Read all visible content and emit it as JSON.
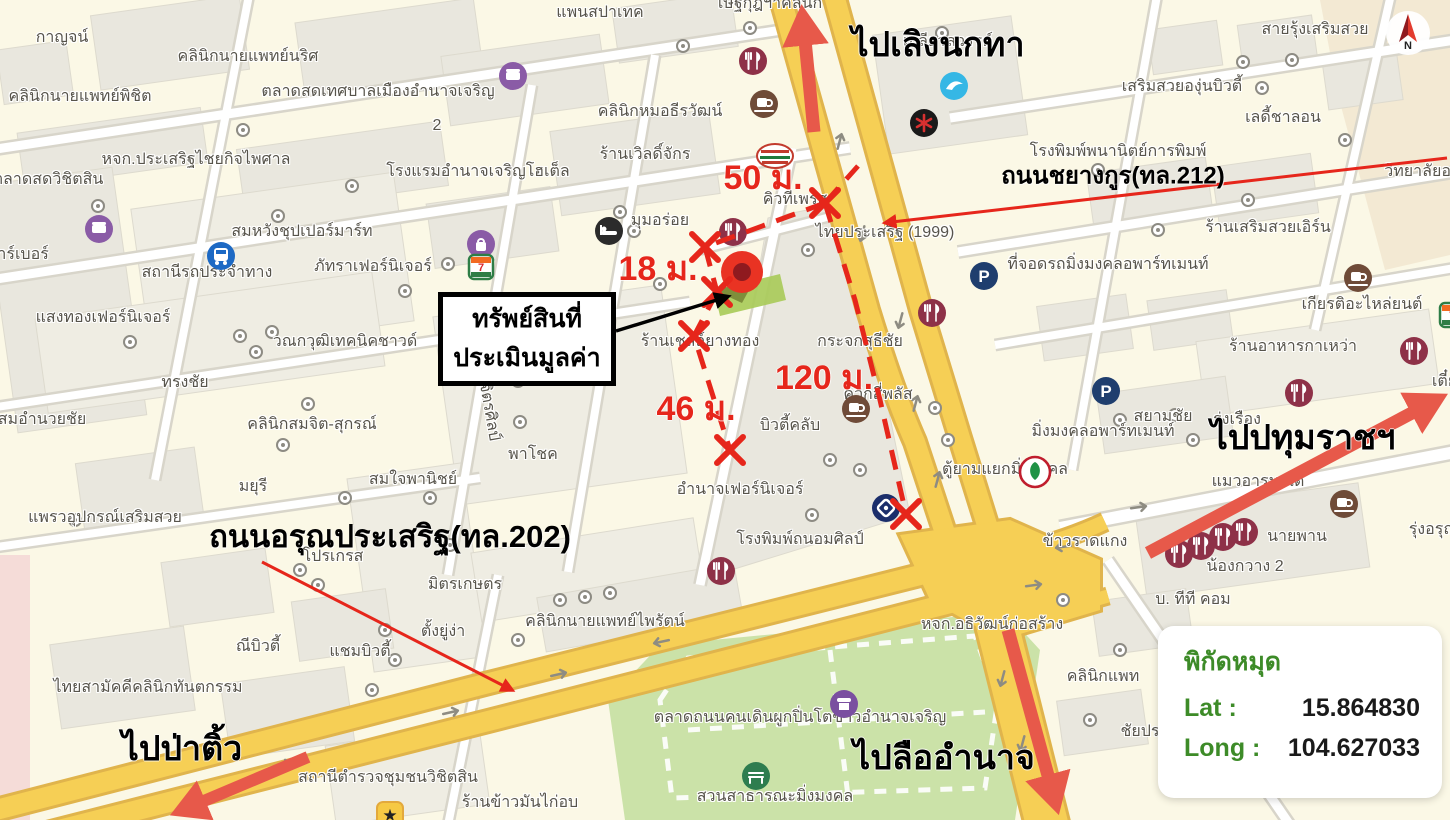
{
  "colors": {
    "land": "#FBF8E6",
    "block": "#E9E7DE",
    "block_light": "#EFEDE3",
    "beige": "#F3E9D3",
    "pink": "#F5DCD8",
    "road_casing": "#D8D5CA",
    "road_fill": "#FFFFFF",
    "yellow": "#F6CF55",
    "yellow_casing": "#E0B44C",
    "park": "#CBE2A8",
    "overlay_red": "#E6261B",
    "arrow_salmon": "#E7594A",
    "marker_red": "#E93323",
    "marker_core": "#8F1A1F",
    "parcel_green": "#A9CB5A",
    "label_gray": "#57544B",
    "panel_green": "#3D8B28"
  },
  "overlay": {
    "property_label": [
      "ทรัพย์สินที่",
      "ประเมินมูลค่า"
    ],
    "distance_labels": [
      {
        "text": "50 ม.",
        "x": 763,
        "y": 177
      },
      {
        "text": "18 ม.",
        "x": 658,
        "y": 268
      },
      {
        "text": "46 ม.",
        "x": 696,
        "y": 408
      },
      {
        "text": "120 ม.",
        "x": 824,
        "y": 377
      }
    ],
    "direction_labels": [
      {
        "text": "ไปเลิงนกทา",
        "x": 938,
        "y": 44
      },
      {
        "text": "ไปปทุมราชฯ",
        "x": 1303,
        "y": 437
      },
      {
        "text": "ไปป่าติ้ว",
        "x": 182,
        "y": 748
      },
      {
        "text": "ไปลืออำนาจ",
        "x": 944,
        "y": 757
      }
    ],
    "road_labels": [
      {
        "text": "ถนนชยางกูร(ทล.212)",
        "x": 1113,
        "y": 175,
        "size": 24
      },
      {
        "text": "ถนนอรุณประเสริฐ(ทล.202)",
        "x": 390,
        "y": 536,
        "size": 31
      }
    ]
  },
  "coordinates_panel": {
    "title": "พิกัดหมุด",
    "lat_label": "Lat :",
    "lat_value": "15.864830",
    "long_label": "Long :",
    "long_value": "104.627033"
  },
  "compass": {
    "letter": "N"
  },
  "map_labels": [
    {
      "t": "กาญจน์",
      "x": 62,
      "y": 38
    },
    {
      "t": "คลินิกนายแพทย์นริศ",
      "x": 248,
      "y": 57
    },
    {
      "t": "คลินิกนายแพทย์พิชิต",
      "x": 80,
      "y": 97
    },
    {
      "t": "ตลาดสดเทศบาลเมืองอำนาจเจริญ",
      "x": 378,
      "y": 92
    },
    {
      "t": "2",
      "x": 437,
      "y": 126
    },
    {
      "t": "แพนสปาเทค",
      "x": 600,
      "y": 13
    },
    {
      "t": "เษฐ์กุฎฯาคลินิก",
      "x": 770,
      "y": 4
    },
    {
      "t": "เกลียวสวรรค์",
      "x": 948,
      "y": 42
    },
    {
      "t": "สายรุ้งเสริมสวย",
      "x": 1315,
      "y": 30
    },
    {
      "t": "เสริมสวยองุ่นบิวตี้",
      "x": 1182,
      "y": 87
    },
    {
      "t": "เลดี้ชาลอน",
      "x": 1283,
      "y": 118
    },
    {
      "t": "หจก.ประเสริฐไชยกิจไพศาล",
      "x": 196,
      "y": 160
    },
    {
      "t": "ตลาดสดวิชิตสิน",
      "x": 48,
      "y": 180
    },
    {
      "t": "คลินิกหมอธีรวัฒน์",
      "x": 660,
      "y": 112
    },
    {
      "t": "โรงแรมอำนาจเจริญโฮเต็ล",
      "x": 478,
      "y": 172
    },
    {
      "t": "ร้านเวิลดิ์จักร",
      "x": 645,
      "y": 155
    },
    {
      "t": "โรงพิมพ์พนานิตย์การพิมพ์",
      "x": 1118,
      "y": 152
    },
    {
      "t": "วิทยาลัยอาชีว",
      "x": 1432,
      "y": 172
    },
    {
      "t": "ร้านเสริมสวยเอิร์น",
      "x": 1268,
      "y": 228
    },
    {
      "t": "มุมอร่อย",
      "x": 660,
      "y": 221
    },
    {
      "t": "คิวทีเพรส",
      "x": 795,
      "y": 200
    },
    {
      "t": "ไทยประเสริฐ (1999)",
      "x": 885,
      "y": 233
    },
    {
      "t": "ที่จอดรถมิ่งมงคลอพาร์ทเมนท์",
      "x": 1108,
      "y": 265
    },
    {
      "t": "เกียรติอะไหล่ยนต์",
      "x": 1362,
      "y": 305
    },
    {
      "t": "บาร์เบอร์",
      "x": 18,
      "y": 255
    },
    {
      "t": "สถานีรถประจำทาง",
      "x": 207,
      "y": 273
    },
    {
      "t": "สมหวังชุปเปอร์มาร์ท",
      "x": 302,
      "y": 232
    },
    {
      "t": "ภัทราเฟอร์นิเจอร์",
      "x": 373,
      "y": 267
    },
    {
      "t": "แสงทองเฟอร์นิเจอร์",
      "x": 103,
      "y": 318
    },
    {
      "t": "วณกวุฒิเทคนิคชาวด์",
      "x": 345,
      "y": 342
    },
    {
      "t": "ทรงชัย",
      "x": 185,
      "y": 383
    },
    {
      "t": "สมอำนวยชัย",
      "x": 42,
      "y": 420
    },
    {
      "t": "วน-เสก-ชด-ทป",
      "x": 562,
      "y": 300
    },
    {
      "t": "กระจกสุธีชัย",
      "x": 860,
      "y": 342
    },
    {
      "t": "มิ่งมงคลอพาร์ทเมนท์",
      "x": 1103,
      "y": 432
    },
    {
      "t": "ร้านอาหารกาเหว่า",
      "x": 1293,
      "y": 347
    },
    {
      "t": "สยามชัย",
      "x": 1163,
      "y": 417
    },
    {
      "t": "รุ่งเรือง",
      "x": 1237,
      "y": 420
    },
    {
      "t": "เตี๋ยวเป็ด",
      "x": 1462,
      "y": 382
    },
    {
      "t": "ร้านเชลล์ยางทอง",
      "x": 700,
      "y": 342
    },
    {
      "t": "ควิกสี่พลัส",
      "x": 878,
      "y": 395
    },
    {
      "t": "บิวตี้คลับ",
      "x": 790,
      "y": 426
    },
    {
      "t": "คลินิกสมจิต-สุกรณ์",
      "x": 312,
      "y": 425
    },
    {
      "t": "พาโชค",
      "x": 533,
      "y": 455
    },
    {
      "t": "มยุรี",
      "x": 253,
      "y": 487
    },
    {
      "t": "สมใจพานิชย์",
      "x": 413,
      "y": 480
    },
    {
      "t": "แพรวอุปกรณ์เสริมสวย",
      "x": 105,
      "y": 518
    },
    {
      "t": "อำนาจเฟอร์นิเจอร์",
      "x": 740,
      "y": 490
    },
    {
      "t": "ตู้ยามแยกมิ่งมงคล",
      "x": 1005,
      "y": 470
    },
    {
      "t": "แมวอารมณ์ดี",
      "x": 1258,
      "y": 482
    },
    {
      "t": "โปรเกรส",
      "x": 333,
      "y": 557
    },
    {
      "t": "นายพาน",
      "x": 1297,
      "y": 537
    },
    {
      "t": "รุ่งอรุณวัสดุ",
      "x": 1448,
      "y": 530
    },
    {
      "t": "น้องกวาง 2",
      "x": 1245,
      "y": 567
    },
    {
      "t": "โรงพิมพ์ถนอมศิลป์",
      "x": 800,
      "y": 540
    },
    {
      "t": "ข้าวราดแกง",
      "x": 1085,
      "y": 542
    },
    {
      "t": "มิตรเกษตร",
      "x": 465,
      "y": 585
    },
    {
      "t": "บ. ทีที คอม",
      "x": 1193,
      "y": 600
    },
    {
      "t": "ณีบิวตี้",
      "x": 258,
      "y": 647
    },
    {
      "t": "แชมบิวตี้",
      "x": 360,
      "y": 652
    },
    {
      "t": "ตั้งยู่ง่า",
      "x": 443,
      "y": 632
    },
    {
      "t": "คลินิกนายแพทย์ไพรัตน์",
      "x": 605,
      "y": 622
    },
    {
      "t": "หจก.อธิวัฒน์ก่อสร้าง",
      "x": 992,
      "y": 625
    },
    {
      "t": "คลินิกแพท",
      "x": 1103,
      "y": 677
    },
    {
      "t": "ไทยสามัคคีคลินิกทันตกรรม",
      "x": 148,
      "y": 688
    },
    {
      "t": "ชัยปร",
      "x": 1140,
      "y": 732
    },
    {
      "t": "สถานีตำรวจชุมชนวิชิตสิน",
      "x": 388,
      "y": 778
    },
    {
      "t": "ร้านข้าวมันไก่อบ",
      "x": 520,
      "y": 803
    },
    {
      "t": "ตลาดถนนคนเดินผูกปิ่นโตข้าวอำนาจเจริญ",
      "x": 800,
      "y": 718
    },
    {
      "t": "สวนสาธารณะมิ่งมงคล",
      "x": 775,
      "y": 797
    },
    {
      "t": "ซ.วิจิตรศิลป์",
      "x": 487,
      "y": 400,
      "rot": 80
    }
  ],
  "icons": [
    {
      "n": "restaurant-icon",
      "x": 737,
      "y": 45
    },
    {
      "n": "restaurant-icon",
      "x": 717,
      "y": 216
    },
    {
      "n": "restaurant-icon",
      "x": 916,
      "y": 297
    },
    {
      "n": "restaurant-icon",
      "x": 1283,
      "y": 377
    },
    {
      "n": "restaurant-icon",
      "x": 1398,
      "y": 335
    },
    {
      "n": "restaurant-icon",
      "x": 705,
      "y": 555
    },
    {
      "n": "restaurant-icon",
      "x": 1163,
      "y": 538
    },
    {
      "n": "restaurant-icon",
      "x": 1185,
      "y": 530
    },
    {
      "n": "restaurant-icon",
      "x": 1207,
      "y": 521
    },
    {
      "n": "restaurant-icon",
      "x": 1228,
      "y": 516
    },
    {
      "n": "coffee-icon",
      "x": 748,
      "y": 88
    },
    {
      "n": "coffee-icon",
      "x": 1342,
      "y": 262
    },
    {
      "n": "coffee-icon",
      "x": 840,
      "y": 393
    },
    {
      "n": "coffee-icon",
      "x": 1328,
      "y": 488
    },
    {
      "n": "pizza-icon",
      "x": 755,
      "y": 142
    },
    {
      "n": "hotel-icon",
      "x": 593,
      "y": 215
    },
    {
      "n": "bus-station-icon",
      "x": 205,
      "y": 240
    },
    {
      "n": "shop-icon",
      "x": 497,
      "y": 60
    },
    {
      "n": "shop-icon",
      "x": 83,
      "y": 213
    },
    {
      "n": "bag-shop-icon",
      "x": 465,
      "y": 228
    },
    {
      "n": "seven-eleven-icon",
      "x": 466,
      "y": 252
    },
    {
      "n": "seven-eleven-icon",
      "x": 1437,
      "y": 300
    },
    {
      "n": "parking-icon",
      "x": 968,
      "y": 260
    },
    {
      "n": "parking-icon",
      "x": 1090,
      "y": 375
    },
    {
      "n": "krungthai-bank-icon",
      "x": 938,
      "y": 70
    },
    {
      "n": "asterisk-icon",
      "x": 908,
      "y": 107
    },
    {
      "n": "bangkok-bank-icon",
      "x": 870,
      "y": 492
    },
    {
      "n": "kasikorn-bank-icon",
      "x": 1018,
      "y": 455
    },
    {
      "n": "market-icon",
      "x": 828,
      "y": 688
    },
    {
      "n": "park-bench-icon",
      "x": 740,
      "y": 760
    },
    {
      "n": "police-star-icon",
      "x": 375,
      "y": 800
    }
  ]
}
